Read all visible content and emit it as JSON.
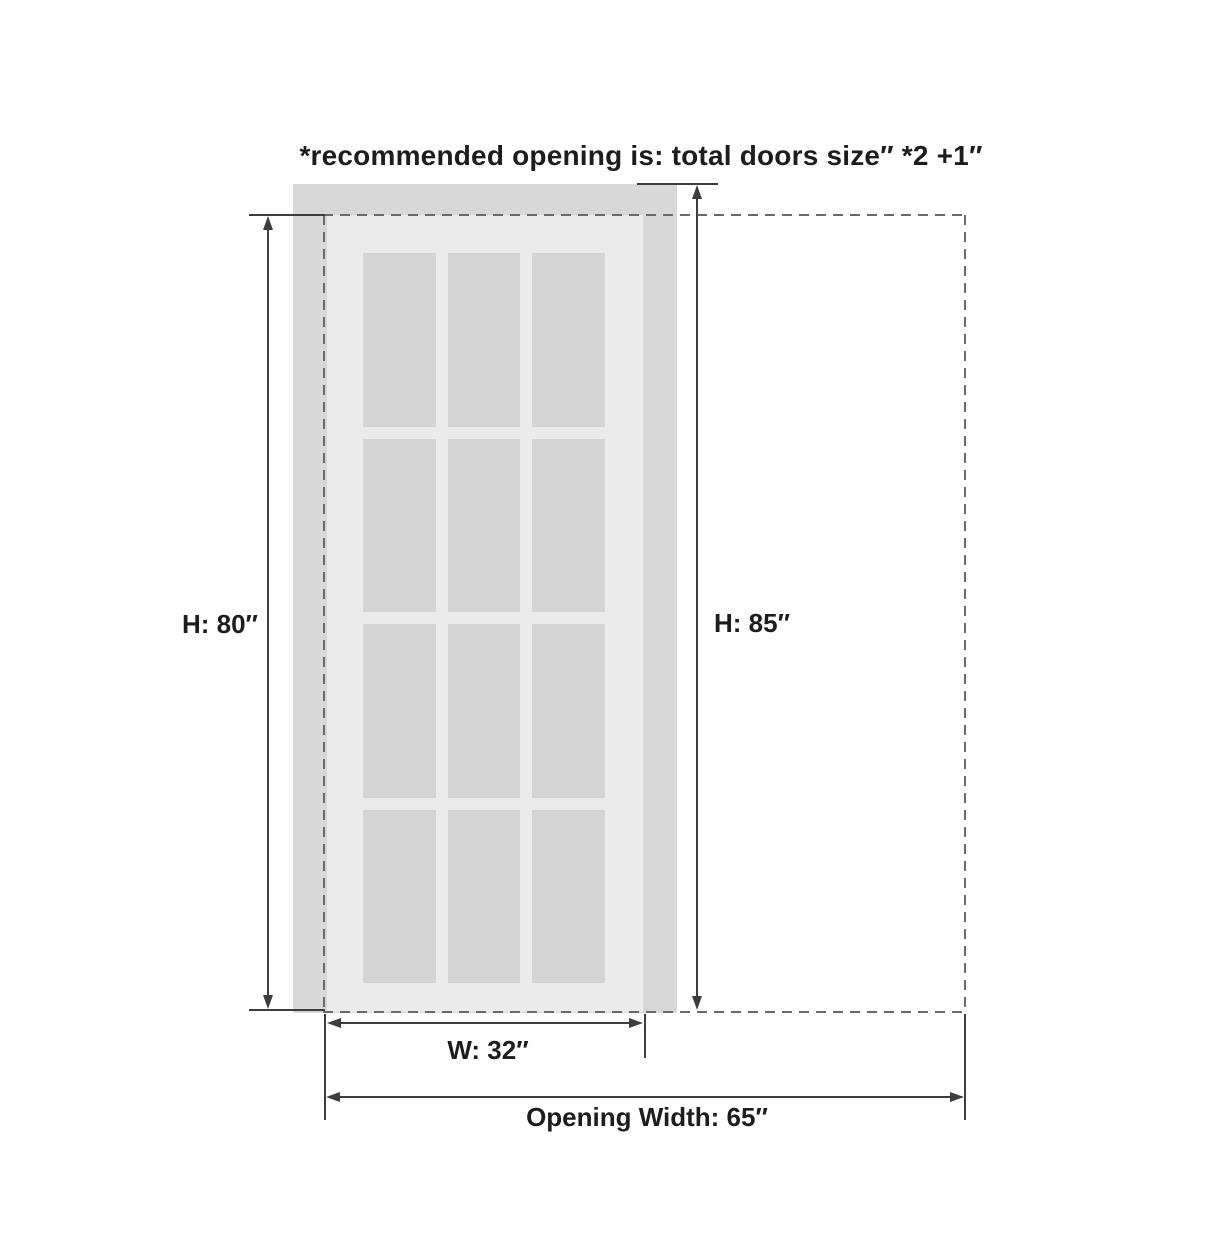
{
  "note": "*recommended opening is: total doors size″ *2 +1″",
  "door": {
    "height_label": "H: 80″",
    "width_label": "W: 32″",
    "glass_grid": {
      "rows": 4,
      "cols": 3
    }
  },
  "opening": {
    "height_label": "H: 85″",
    "width_label": "Opening Width: 65″"
  },
  "colors": {
    "wall": "#d8d8d8",
    "door": "#ebebeb",
    "glass": "#d4d4d4",
    "line": "#3d3d3d",
    "dash": "#6a6a6a",
    "text": "#1d1d1d"
  }
}
